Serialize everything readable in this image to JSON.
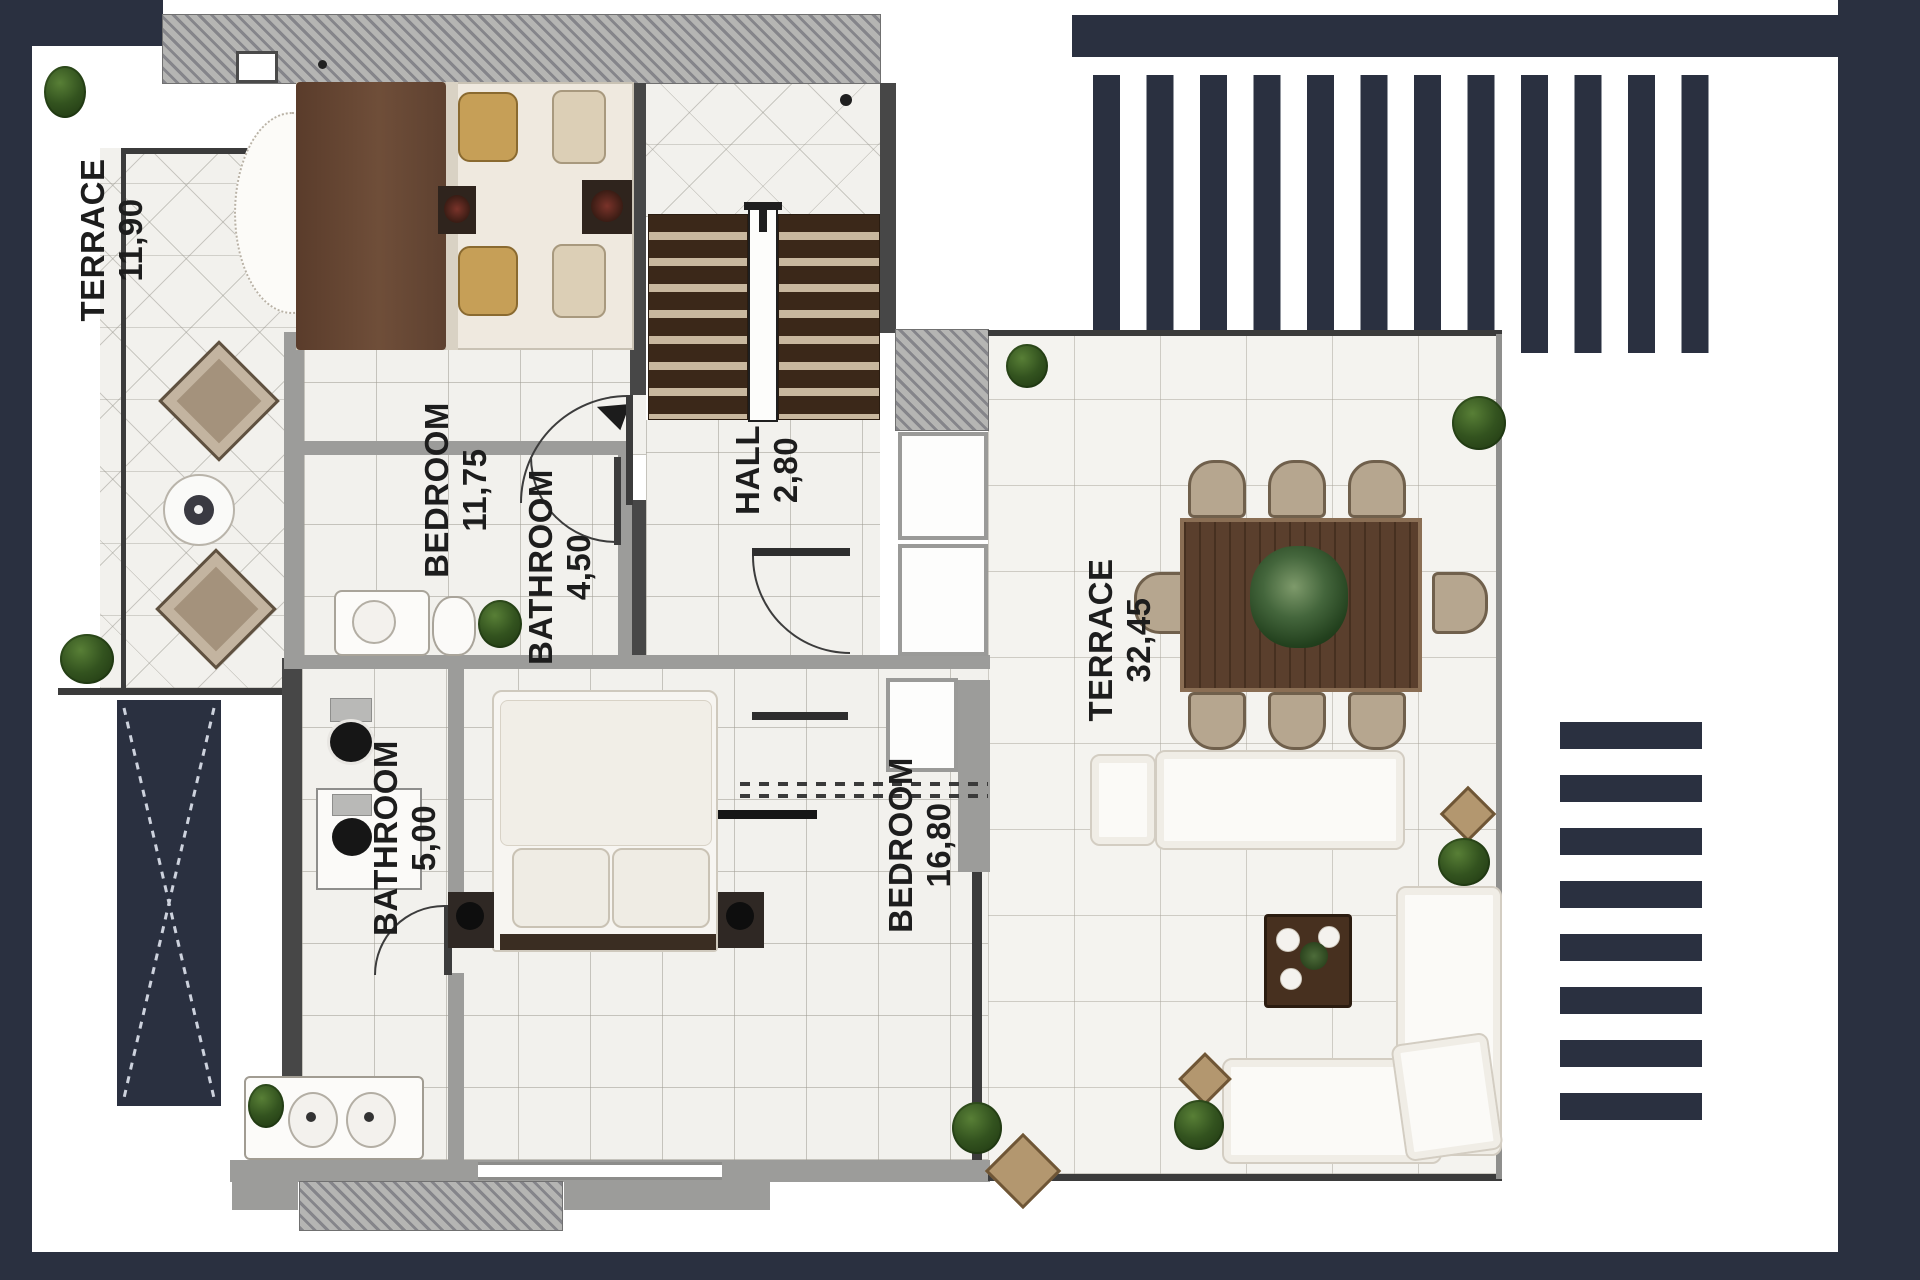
{
  "rooms": [
    {
      "name": "TERRACE",
      "area": "11,90"
    },
    {
      "name": "BEDROOM",
      "area": "11,75"
    },
    {
      "name": "HALL",
      "area": "2,80"
    },
    {
      "name": "BATHROOM",
      "area": "4,50"
    },
    {
      "name": "BATHROOM",
      "area": "5,00"
    },
    {
      "name": "BEDROOM",
      "area": "16,80"
    },
    {
      "name": "TERRACE",
      "area": "32,45"
    }
  ],
  "pergolas": {
    "top_stripe_count": 12,
    "right_stripe_count": 8
  },
  "colors": {
    "frame_navy": "#2a3040",
    "wall_gray": "#9c9c9a",
    "wall_dark": "#474747",
    "floor_tile": "#f2f1ed",
    "wood_table": "#5a3f2d",
    "wood_dark": "#44301f",
    "stair_tread": "#3b2819",
    "chair_tan": "#b6a68f",
    "furniture_white": "#fbfaf7"
  }
}
